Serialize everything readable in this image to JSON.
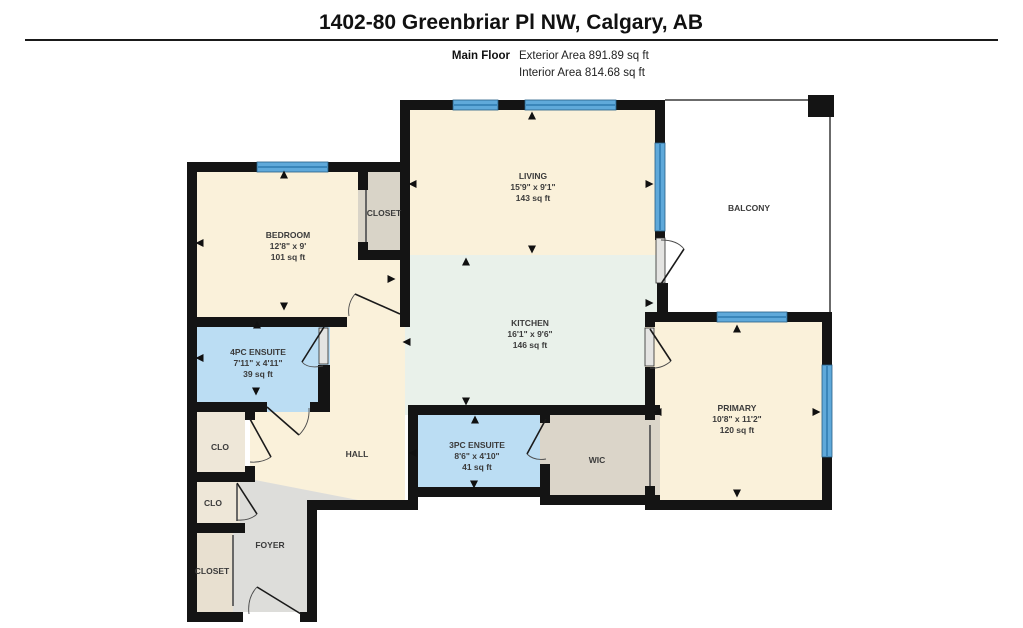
{
  "header": {
    "title": "1402-80 Greenbriar Pl NW, Calgary, AB",
    "floor_label": "Main Floor",
    "exterior_area": "Exterior Area 891.89 sq ft",
    "interior_area": "Interior Area 814.68 sq ft"
  },
  "rooms": {
    "living": {
      "name": "LIVING",
      "dims": "15'9\" x 9'1\"",
      "area": "143 sq ft"
    },
    "bedroom": {
      "name": "BEDROOM",
      "dims": "12'8\" x 9'",
      "area": "101 sq ft"
    },
    "kitchen": {
      "name": "KITCHEN",
      "dims": "16'1\" x 9'6\"",
      "area": "146 sq ft"
    },
    "ensuite4pc": {
      "name": "4PC ENSUITE",
      "dims": "7'11\" x 4'11\"",
      "area": "39 sq ft"
    },
    "ensuite3pc": {
      "name": "3PC ENSUITE",
      "dims": "8'6\" x 4'10\"",
      "area": "41 sq ft"
    },
    "primary": {
      "name": "PRIMARY",
      "dims": "10'8\" x 11'2\"",
      "area": "120 sq ft"
    },
    "balcony": {
      "name": "BALCONY"
    },
    "closet_bedroom": {
      "name": "CLOSET"
    },
    "wic": {
      "name": "WIC"
    },
    "hall": {
      "name": "HALL"
    },
    "foyer": {
      "name": "FOYER"
    },
    "clo_upper": {
      "name": "CLO"
    },
    "clo_lower": {
      "name": "CLO"
    },
    "closet_entry": {
      "name": "CLOSET"
    }
  },
  "colors": {
    "wall": "#141414",
    "room_cream": "#FAF1DA",
    "kitchen_mint": "#E9F1EA",
    "ensuite_blue": "#BBDDF3",
    "closet_gray": "#D9D4C8",
    "wic_gray": "#DBD5C9",
    "clo_beige": "#EEE7D8",
    "closet_entry_beige": "#E8E0D0",
    "foyer_gray": "#DDDDDA",
    "window_blue": "#5FA9DA",
    "window_edge": "#255E85",
    "balcony_outline": "#3a3a3a"
  }
}
